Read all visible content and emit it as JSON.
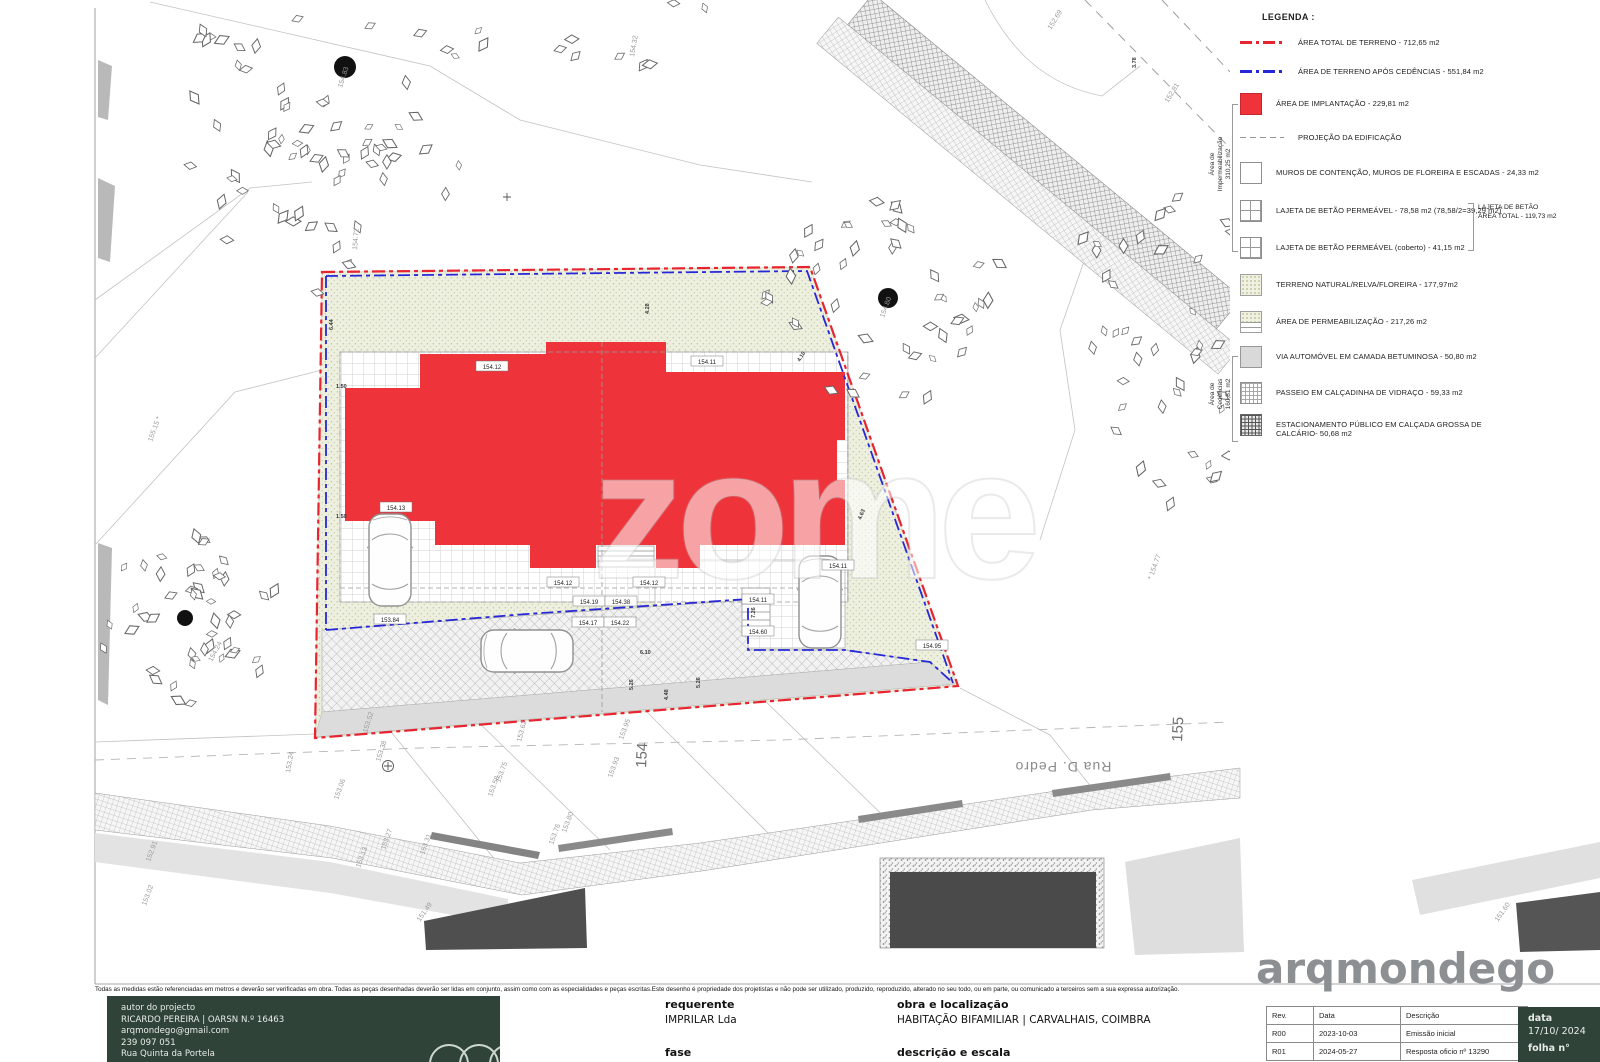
{
  "legend": {
    "title": "LEGENDA :",
    "items": [
      {
        "swatch": "red-line",
        "label": "ÁREA TOTAL DE TERRENO - 712,65 m2"
      },
      {
        "swatch": "blue-line",
        "label": "ÁREA DE TERRENO APÓS CEDÊNCIAS - 551,84 m2"
      },
      {
        "swatch": "red-fill",
        "label": "ÁREA DE IMPLANTAÇÃO - 229,81 m2"
      },
      {
        "swatch": "gray-dash",
        "label": "PROJEÇÃO DA EDIFICAÇÃO"
      },
      {
        "swatch": "plain",
        "label": "MUROS DE CONTENÇÃO, MUROS DE FLOREIRA E ESCADAS - 24,33 m2"
      },
      {
        "swatch": "grid2",
        "label": "LAJETA DE BETÃO PERMEÁVEL - 78,58 m2  (78,58/2=39,29 m2)"
      },
      {
        "swatch": "grid2",
        "label": "LAJETA DE BETÃO PERMEÁVEL (coberto) - 41,15 m2"
      },
      {
        "swatch": "speckle",
        "label": "TERRENO NATURAL/RELVA/FLOREIRA - 177,97m2"
      },
      {
        "swatch": "speckle-half",
        "label": "ÁREA DE PERMEABILIZAÇÃO - 217,26 m2"
      },
      {
        "swatch": "gray-fill",
        "label": "VIA AUTOMÓVEL EM CAMADA BETUMINOSA - 50,80 m2"
      },
      {
        "swatch": "fine-grid",
        "label": "PASSEIO EM CALÇADINHA DE VIDRAÇO - 59,33 m2"
      },
      {
        "swatch": "dense-grid",
        "label": "ESTACIONAMENTO PÚBLICO EM CALÇADA GROSSA DE CALCÁRIO- 50,68 m2"
      }
    ],
    "imp_label": [
      "Área de",
      "Impermeabilização",
      "310,25 m2"
    ],
    "ced_label": [
      "Área de",
      "Cedências",
      "160,81 m2"
    ],
    "lajeta_note": [
      "LAJETA DE BETÃO",
      "ÁREA TOTAL - 119,73 m2"
    ]
  },
  "watermark": "zome",
  "street_name": "Rua D. Pedro",
  "titleblock": {
    "disclaimer": "Todas as medidas estão referenciadas em metros e deverão ser verificadas em obra. Todas as peças desenhadas deverão ser lidas em conjunto, assim como com as especialidades e peças escritas.Este desenho é propriedade dos projetistas e não pode ser utilizado, produzido, reproduzido, alterado no seu todo, ou em parte, ou comunicado a terceiros sem a sua expressa autorização.",
    "author": {
      "heading": "autor do projecto",
      "name": "RICARDO PEREIRA | OARSN N.º 16463",
      "email": "arqmondego@gmail.com",
      "phone": "239 097 051",
      "address": "Rua Quinta da Portela"
    },
    "requerente": {
      "heading": "requerente",
      "value": "IMPRILAR Lda"
    },
    "obra": {
      "heading": "obra e localização",
      "value": "HABITAÇÃO BIFAMILIAR | CARVALHAIS, COIMBRA"
    },
    "fase": {
      "heading": "fase"
    },
    "descricao": {
      "heading": "descrição e escala"
    },
    "revisions": {
      "headers": [
        "Rev.",
        "Data",
        "Descrição"
      ],
      "rows": [
        [
          "R00",
          "2023-10-03",
          "Emissão inicial"
        ],
        [
          "R01",
          "2024-05-27",
          "Resposta oficio nº 13290"
        ]
      ]
    },
    "data_box": {
      "heading": "data",
      "value": "17/10/ 2024",
      "folha_heading": "folha n°"
    },
    "logo": "arqmondego"
  },
  "plan": {
    "spot_labels": [
      {
        "t": "154.83",
        "x": 342,
        "y": 88,
        "r": -72
      },
      {
        "t": "154.32",
        "x": 634,
        "y": 57,
        "r": -80
      },
      {
        "t": "152.69",
        "x": 1051,
        "y": 30,
        "r": -58
      },
      {
        "t": "152.81",
        "x": 1168,
        "y": 103,
        "r": -58
      },
      {
        "t": "154.72",
        "x": 357,
        "y": 250,
        "r": -85
      },
      {
        "t": "155.15 *",
        "x": 152,
        "y": 442,
        "r": -70
      },
      {
        "t": "154.80",
        "x": 884,
        "y": 318,
        "r": -70
      },
      {
        "t": "* 154.77",
        "x": 1152,
        "y": 580,
        "r": -70
      },
      {
        "t": "154.24",
        "x": 212,
        "y": 662,
        "r": -62
      },
      {
        "t": "153.24",
        "x": 290,
        "y": 773,
        "r": -80
      },
      {
        "t": "153.52",
        "x": 367,
        "y": 733,
        "r": -72
      },
      {
        "t": "153.38",
        "x": 380,
        "y": 762,
        "r": -72
      },
      {
        "t": "153.62",
        "x": 521,
        "y": 742,
        "r": -75
      },
      {
        "t": "153.95",
        "x": 623,
        "y": 740,
        "r": -70
      },
      {
        "t": "153.93",
        "x": 612,
        "y": 778,
        "r": -70
      },
      {
        "t": "153.75",
        "x": 500,
        "y": 783,
        "r": -70
      },
      {
        "t": "153.58",
        "x": 492,
        "y": 797,
        "r": -70
      },
      {
        "t": "153.76",
        "x": 553,
        "y": 845,
        "r": -70
      },
      {
        "t": "153.80",
        "x": 566,
        "y": 833,
        "r": -70
      },
      {
        "t": "153.31",
        "x": 424,
        "y": 855,
        "r": -70
      },
      {
        "t": "153.27",
        "x": 385,
        "y": 850,
        "r": -70
      },
      {
        "t": "153.13",
        "x": 360,
        "y": 868,
        "r": -70
      },
      {
        "t": "153.06",
        "x": 338,
        "y": 800,
        "r": -70
      },
      {
        "t": "152.91",
        "x": 150,
        "y": 862,
        "r": -70
      },
      {
        "t": "153.02",
        "x": 146,
        "y": 906,
        "r": -70
      },
      {
        "t": "151.49",
        "x": 420,
        "y": 922,
        "r": -55
      },
      {
        "t": "151.60",
        "x": 1498,
        "y": 922,
        "r": -55
      },
      {
        "t": "154",
        "x": 646,
        "y": 768,
        "r": -87,
        "big": true
      },
      {
        "t": "155",
        "x": 1182,
        "y": 742,
        "r": -87,
        "big": true
      }
    ],
    "boxed_labels": [
      {
        "t": "154.12",
        "x": 492,
        "y": 367
      },
      {
        "t": "154.11",
        "x": 707,
        "y": 362
      },
      {
        "t": "154.13",
        "x": 396,
        "y": 508
      },
      {
        "t": "154.12",
        "x": 563,
        "y": 583
      },
      {
        "t": "154.12",
        "x": 649,
        "y": 583
      },
      {
        "t": "154.19",
        "x": 589,
        "y": 602
      },
      {
        "t": "154.38",
        "x": 621,
        "y": 602
      },
      {
        "t": "154.11",
        "x": 758,
        "y": 600
      },
      {
        "t": "154.17",
        "x": 588,
        "y": 623
      },
      {
        "t": "154.22",
        "x": 620,
        "y": 623
      },
      {
        "t": "154.60",
        "x": 758,
        "y": 632
      },
      {
        "t": "153.84",
        "x": 390,
        "y": 620
      },
      {
        "t": "154.11",
        "x": 838,
        "y": 566
      },
      {
        "t": "154.95",
        "x": 932,
        "y": 646
      }
    ],
    "dim_labels": [
      {
        "t": "6.44",
        "x": 333,
        "y": 330,
        "r": -90
      },
      {
        "t": "1.50",
        "x": 336,
        "y": 388,
        "r": 0
      },
      {
        "t": "1.50",
        "x": 336,
        "y": 518,
        "r": 0
      },
      {
        "t": "4.28",
        "x": 649,
        "y": 314,
        "r": -90
      },
      {
        "t": "4.10",
        "x": 800,
        "y": 362,
        "r": -60
      },
      {
        "t": "4.63",
        "x": 861,
        "y": 520,
        "r": -68
      },
      {
        "t": "6.10",
        "x": 640,
        "y": 654,
        "r": 0
      },
      {
        "t": "5.26",
        "x": 633,
        "y": 690,
        "r": -90
      },
      {
        "t": "5.26",
        "x": 700,
        "y": 688,
        "r": -90
      },
      {
        "t": "4.48",
        "x": 668,
        "y": 700,
        "r": -90
      },
      {
        "t": "7.26",
        "x": 755,
        "y": 618,
        "r": -90
      },
      {
        "t": "3.78",
        "x": 1136,
        "y": 68,
        "r": -90
      }
    ]
  },
  "colors": {
    "boundary_red": "#e82430",
    "cedencia_blue": "#2628d8",
    "implantacao_red": "#ee333a",
    "titleblock_green": "#2f4339",
    "logo_gray": "#8d9092"
  }
}
